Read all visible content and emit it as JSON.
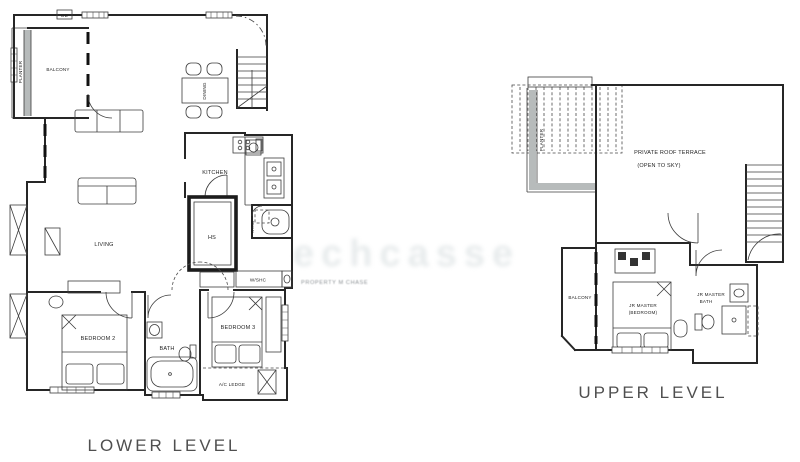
{
  "lower": {
    "caption": "LOWER LEVEL",
    "rooms": {
      "db": "DB",
      "planter": "PLANTER",
      "balcony": "BALCONY",
      "dining": "DINING",
      "kitchen": "KITCHEN",
      "yard": "YARD",
      "wshc": "W/SHC",
      "hs": "HS",
      "living": "LIVING",
      "bedroom2": "BEDROOM 2",
      "bath": "BATH",
      "bedroom3": "BEDROOM 3",
      "ac": "A/C LEDGE"
    }
  },
  "upper": {
    "caption": "UPPER LEVEL",
    "rooms": {
      "planter": "PLANTER",
      "terrace1": "PRIVATE ROOF TERRACE",
      "terrace2": "(OPEN TO SKY)",
      "balcony": "BALCONY",
      "jr1": "JR MASTER",
      "jr2": "(BEDROOM)",
      "bath1": "JR MASTER",
      "bath2": "BATH"
    }
  },
  "watermark": {
    "large": "echcasse",
    "small": "PROPERTY M CHASE"
  },
  "colors": {
    "line": "#262626",
    "caption": "#4f4f4f",
    "watermark_large": "#e7ebec",
    "watermark_small": "#8d9296"
  }
}
